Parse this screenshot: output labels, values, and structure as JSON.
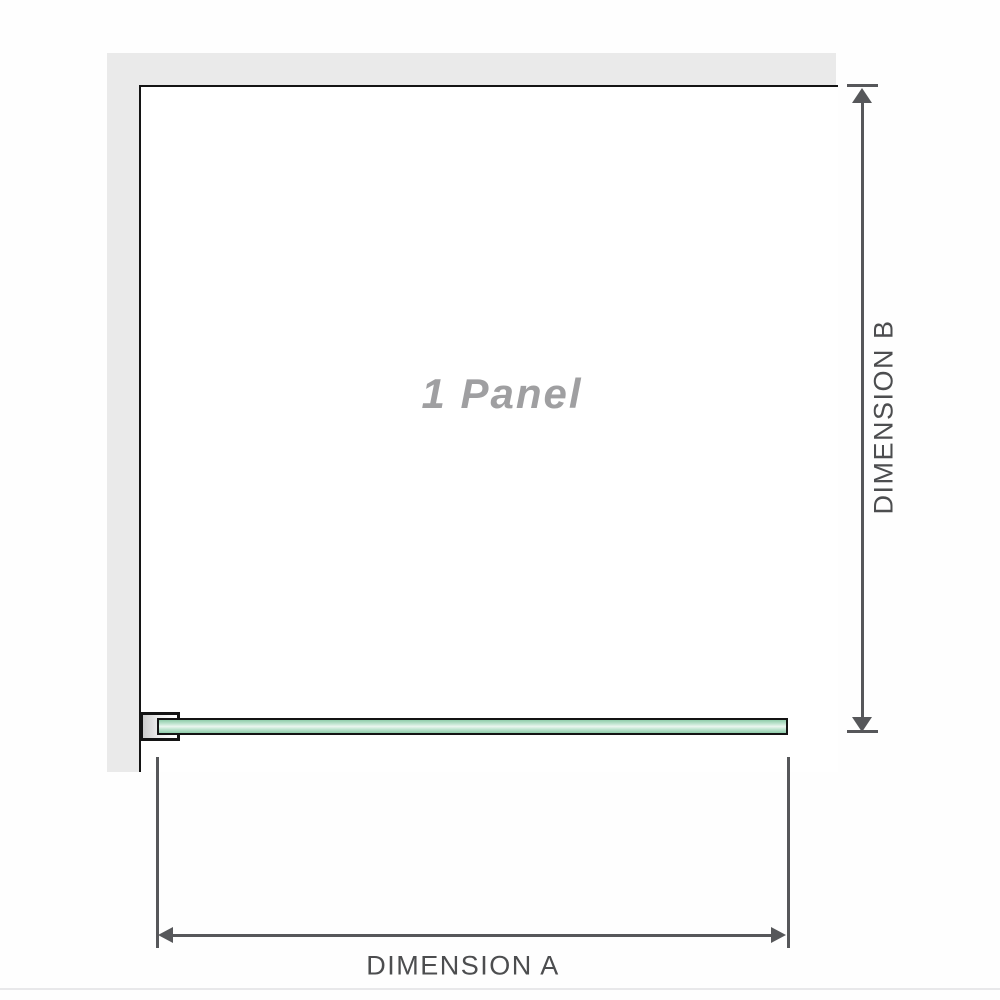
{
  "panel": {
    "label": "1 Panel"
  },
  "dimensions": {
    "a_label": "DIMENSION A",
    "b_label": "DIMENSION B"
  },
  "icons": {
    "dim_b_arrow_up": "triangle-up",
    "dim_b_arrow_down": "triangle-down",
    "dim_a_arrow_left": "triangle-left",
    "dim_a_arrow_right": "triangle-right"
  },
  "colors": {
    "wall_fill": "#eaeaea",
    "outline": "#141414",
    "dimension_line": "#56575a",
    "dimension_text": "#4c4d4f",
    "panel_label_text": "#9f9fa1",
    "glass_green": "#8fcdaa",
    "glass_highlight": "#ecf7f0"
  }
}
